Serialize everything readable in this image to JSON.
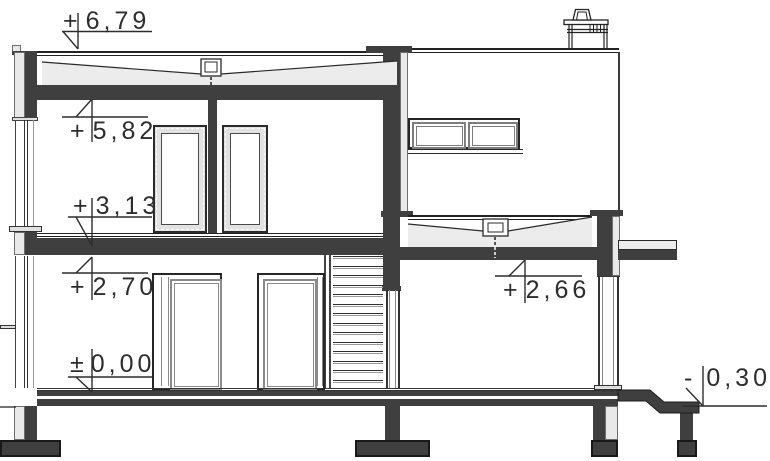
{
  "drawing": {
    "name": "house-cross-section",
    "levels": [
      {
        "label": "roof-attic-top",
        "sign": "+",
        "value": "6,79"
      },
      {
        "label": "upper-ceiling-soffit",
        "sign": "+",
        "value": "5,82"
      },
      {
        "label": "upper-floor-finish",
        "sign": "+",
        "value": "3,13"
      },
      {
        "label": "ground-ceiling-soffit",
        "sign": "+",
        "value": "2,70"
      },
      {
        "label": "annex-ceiling-soffit",
        "sign": "+",
        "value": "2,66"
      },
      {
        "label": "ground-floor-finish",
        "sign": "±",
        "value": "0,00"
      },
      {
        "label": "exterior-grade",
        "sign": "-",
        "value": "0,30"
      }
    ],
    "colors": {
      "cut": "#3f3f3f",
      "insulation": "#e9e9e9",
      "lines": "#2a2a2a",
      "frame": "#868686",
      "background": "#ffffff"
    }
  }
}
